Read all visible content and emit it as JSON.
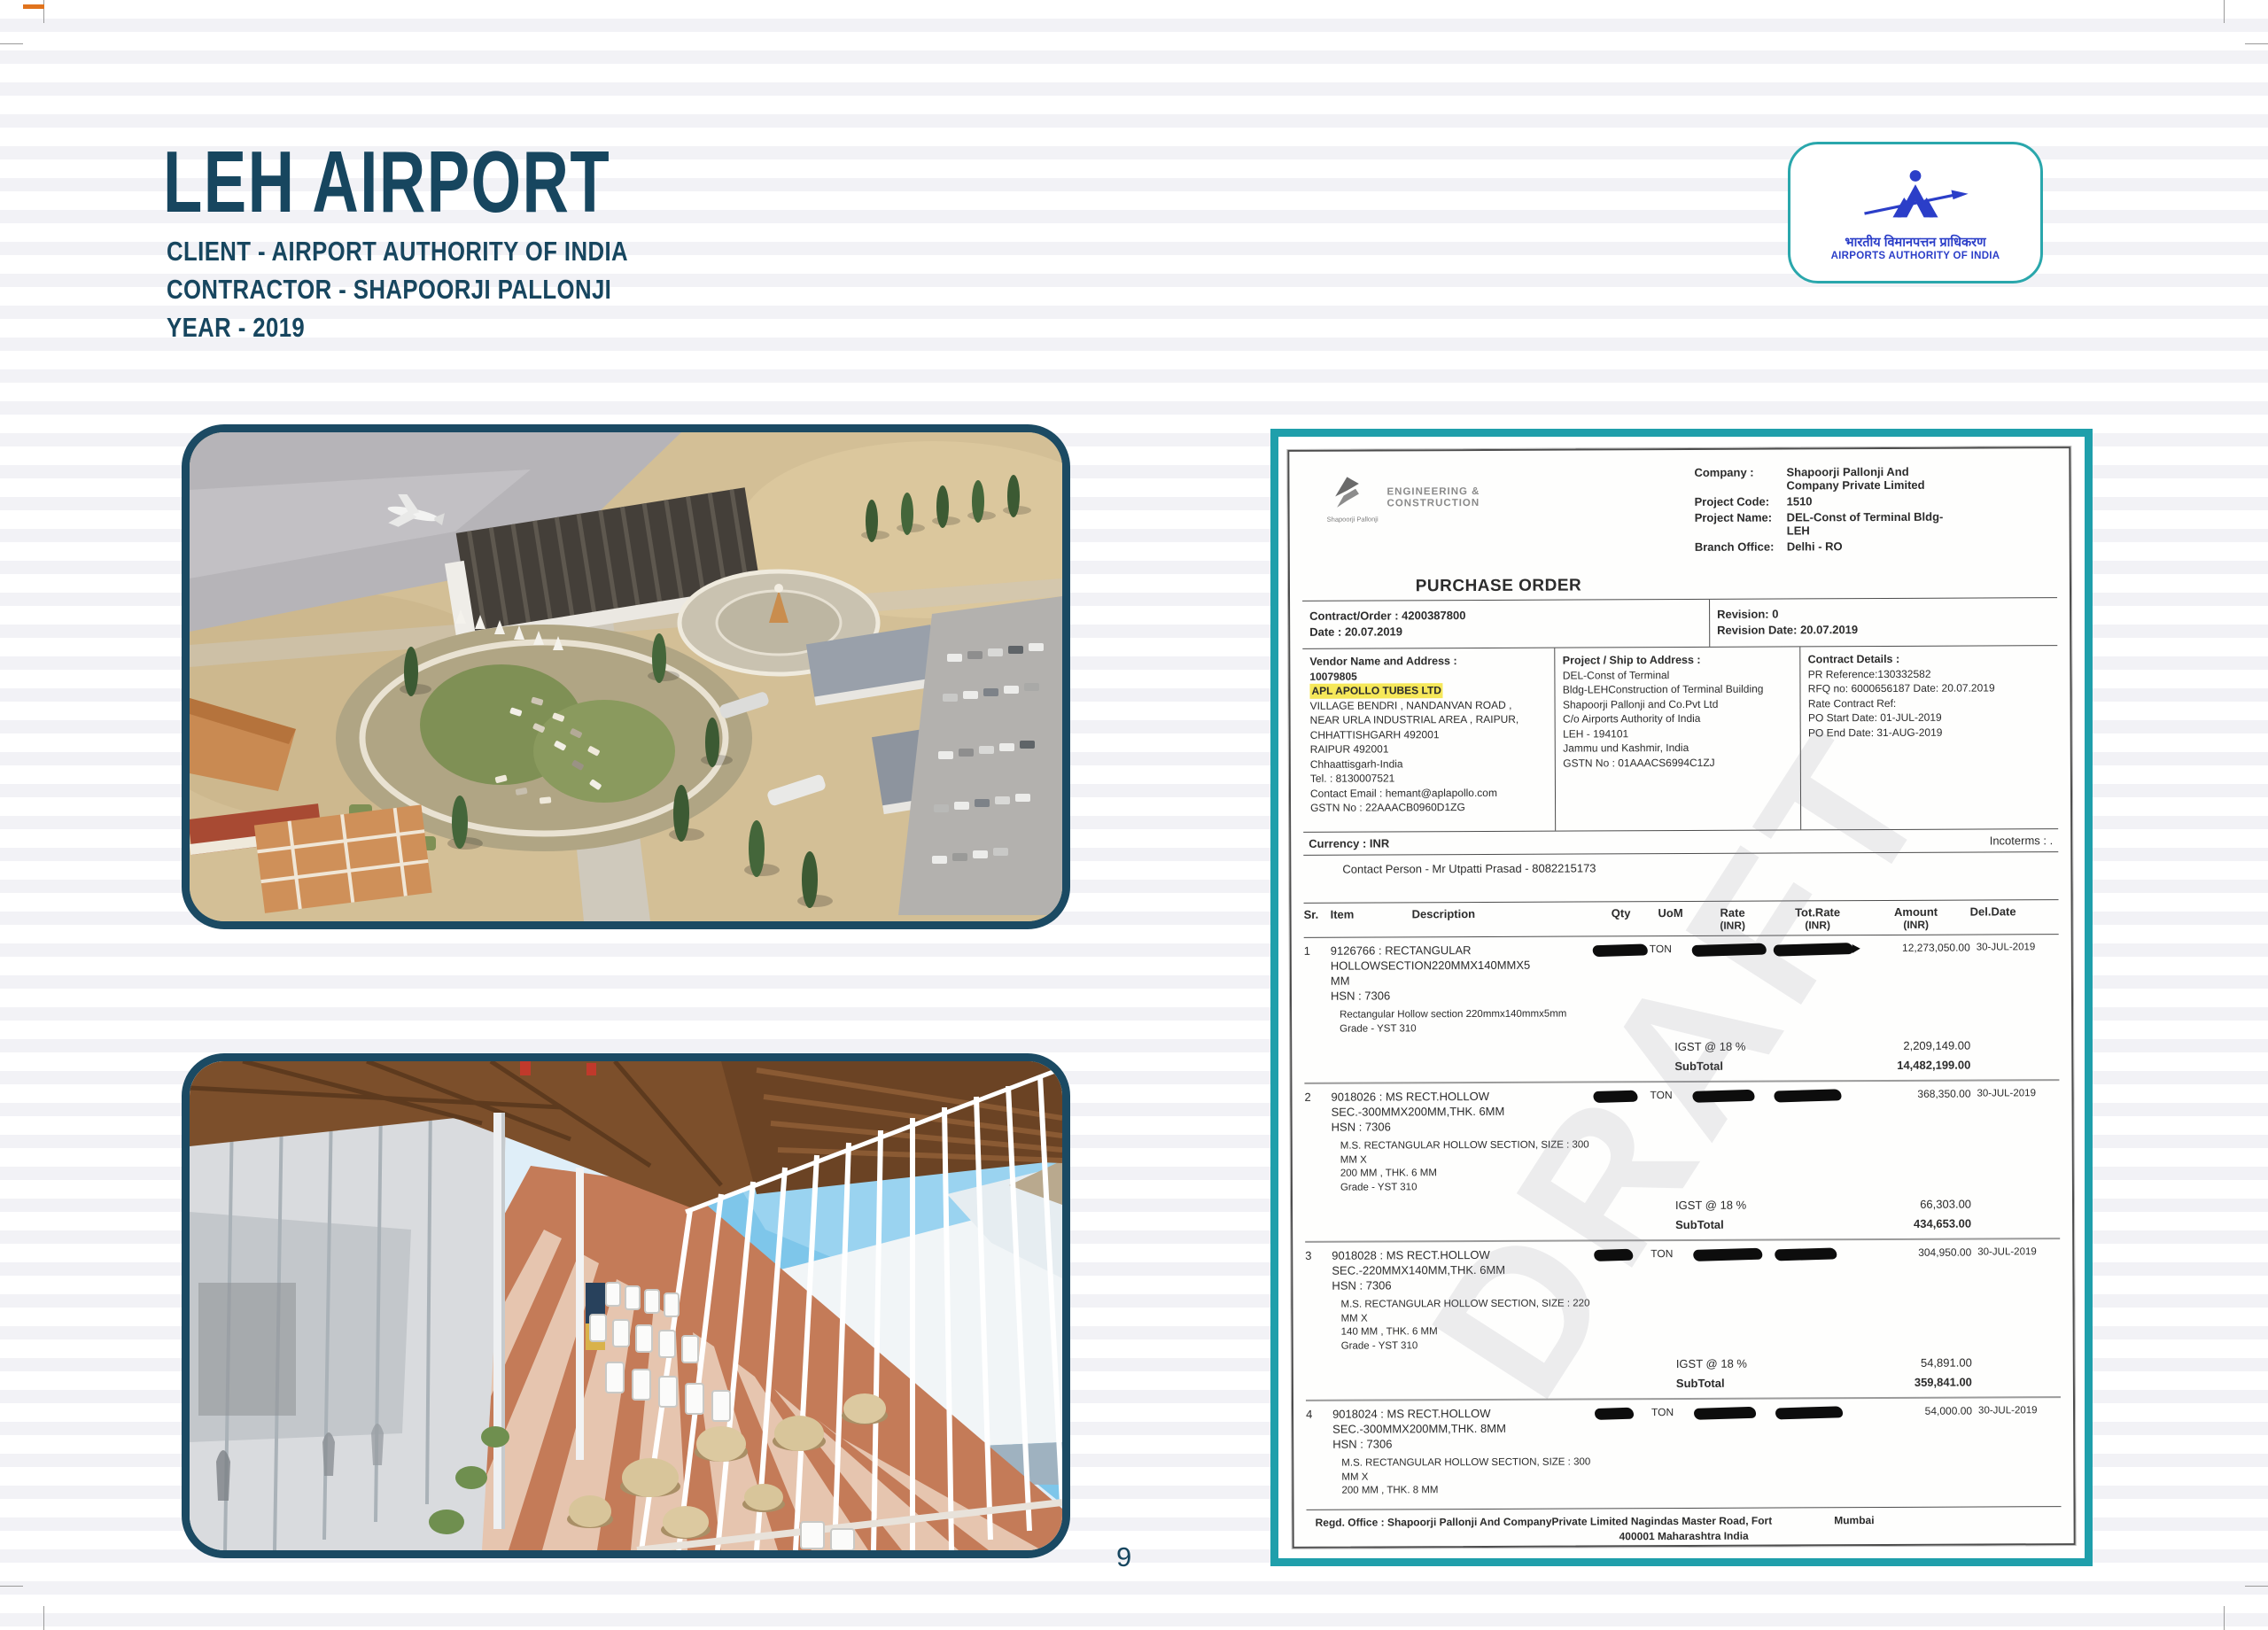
{
  "page": {
    "number": "9"
  },
  "colors": {
    "heading_navy": "#17465f",
    "frame_teal": "#1f9fab",
    "aai_blue": "#2b3ec8",
    "highlight_yellow": "#f6e85a",
    "image_border_navy": "#1b4a63"
  },
  "header": {
    "title": "LEH AIRPORT",
    "client_line": "CLIENT - AIRPORT AUTHORITY OF INDIA",
    "contractor_line": "CONTRACTOR - SHAPOORJI PALLONJI",
    "year_line": "YEAR - 2019"
  },
  "aai_logo": {
    "hindi_text": "भारतीय विमानपत्तन प्राधिकरण",
    "english_text": "AIRPORTS AUTHORITY OF INDIA"
  },
  "purchase_order": {
    "sp_brand": "Shapoorji Pallonji",
    "sp_tagline1": "ENGINEERING &",
    "sp_tagline2": "CONSTRUCTION",
    "title": "PURCHASE ORDER",
    "watermark": "DRAFT",
    "meta": {
      "company_label": "Company :",
      "company_value": "Shapoorji Pallonji And Company Private Limited",
      "project_code_label": "Project Code:",
      "project_code_value": "1510",
      "project_name_label": "Project Name:",
      "project_name_value": "DEL-Const of Terminal Bldg-LEH",
      "branch_label": "Branch Office:",
      "branch_value": "Delhi - RO"
    },
    "contract_row": {
      "contract_order": "Contract/Order : 4200387800",
      "date": "Date : 20.07.2019",
      "revision": "Revision: 0",
      "revision_date": "Revision Date:  20.07.2019"
    },
    "vendor": {
      "heading": "Vendor Name and Address :",
      "code": "10079805",
      "name": "APL APOLLO TUBES LTD",
      "lines": [
        "VILLAGE BENDRI , NANDANVAN ROAD ,",
        "NEAR URLA INDUSTRIAL AREA , RAIPUR,",
        "CHHATTISHGARH 492001",
        "RAIPUR 492001",
        "Chhaattisgarh-India",
        "Tel. : 8130007521",
        "Contact Email : hemant@aplapollo.com",
        "GSTN No : 22AAACB0960D1ZG"
      ]
    },
    "ship_to": {
      "heading": "Project / Ship to Address :",
      "lines": [
        "DEL-Const of Terminal",
        "Bldg-LEHConstruction of Terminal Building",
        "Shapoorji Pallonji and Co.Pvt Ltd",
        "C/o Airports Authority of India",
        "LEH - 194101",
        "Jammu und Kashmir, India",
        "GSTN No : 01AAACS6994C1ZJ"
      ]
    },
    "contract_details": {
      "heading": "Contract Details :",
      "lines": [
        "PR Reference:130332582",
        "RFQ no: 6000656187   Date: 20.07.2019",
        "Rate Contract Ref:",
        "PO Start Date: 01-JUL-2019",
        "PO End Date:  31-AUG-2019"
      ]
    },
    "currency": "Currency : INR",
    "incoterms": "Incoterms : .",
    "contact": "Contact Person - Mr Utpatti Prasad - 8082215173",
    "table": {
      "headers": {
        "sr": "Sr.",
        "item": "Item",
        "description": "Description",
        "qty": "Qty",
        "uom": "UoM",
        "rate": "Rate",
        "tot_rate": "Tot.Rate",
        "amount": "Amount",
        "del_date": "Del.Date",
        "inr": "(INR)"
      },
      "items": [
        {
          "sr": "1",
          "code": "9126766 : RECTANGULAR",
          "desc1": "HOLLOWSECTION220MMX140MMX5",
          "desc2": "MM",
          "hsn": "HSN : 7306",
          "detail1": "Rectangular Hollow section 220mmx140mmx5mm",
          "detail2": "Grade - YST 310",
          "uom": "TON",
          "amount": "12,273,050.00",
          "del_date": "30-JUL-2019",
          "igst_label": "IGST @ 18 %",
          "igst_value": "2,209,149.00",
          "subtotal_label": "SubTotal",
          "subtotal_value": "14,482,199.00"
        },
        {
          "sr": "2",
          "code": "9018026 : MS RECT.HOLLOW",
          "desc1": "SEC.-300MMX200MM,THK. 6MM",
          "hsn": "HSN : 7306",
          "detail1": "M.S. RECTANGULAR HOLLOW SECTION, SIZE : 300 MM X",
          "detail2": "200 MM , THK. 6 MM",
          "detail3": "Grade - YST 310",
          "uom": "TON",
          "amount": "368,350.00",
          "del_date": "30-JUL-2019",
          "igst_label": "IGST @ 18 %",
          "igst_value": "66,303.00",
          "subtotal_label": "SubTotal",
          "subtotal_value": "434,653.00"
        },
        {
          "sr": "3",
          "code": "9018028 : MS RECT.HOLLOW",
          "desc1": "SEC.-220MMX140MM,THK. 6MM",
          "hsn": "HSN : 7306",
          "detail1": "M.S. RECTANGULAR HOLLOW SECTION, SIZE : 220 MM X",
          "detail2": "140 MM , THK. 6 MM",
          "detail3": "Grade - YST 310",
          "uom": "TON",
          "amount": "304,950.00",
          "del_date": "30-JUL-2019",
          "igst_label": "IGST @ 18 %",
          "igst_value": "54,891.00",
          "subtotal_label": "SubTotal",
          "subtotal_value": "359,841.00"
        },
        {
          "sr": "4",
          "code": "9018024 : MS RECT.HOLLOW",
          "desc1": "SEC.-300MMX200MM,THK. 8MM",
          "hsn": "HSN : 7306",
          "detail1": "M.S. RECTANGULAR HOLLOW SECTION, SIZE : 300 MM X",
          "detail2": "200 MM , THK. 8 MM",
          "uom": "TON",
          "amount": "54,000.00",
          "del_date": "30-JUL-2019"
        }
      ]
    },
    "footer": {
      "line1": "Regd. Office : Shapoorji Pallonji And CompanyPrivate Limited Nagindas Master Road, Fort",
      "line1_right": "Mumbai",
      "line2": "400001 Maharashtra India",
      "line3": "CIN No. : U45200MH1943PTC003812"
    }
  }
}
